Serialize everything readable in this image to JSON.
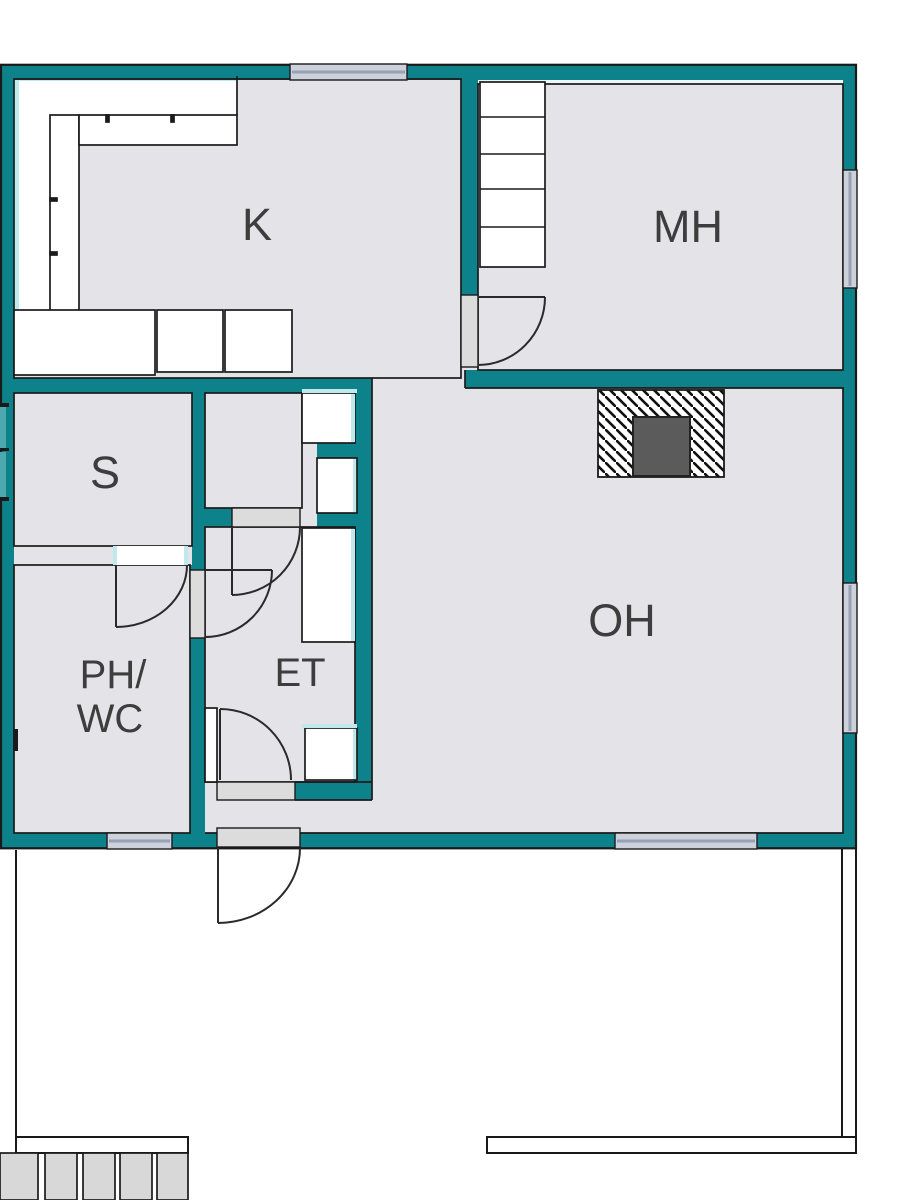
{
  "plan": {
    "type": "apartment-floor-plan",
    "rooms": {
      "k": {
        "label": "K",
        "meaning": "kitchen"
      },
      "mh": {
        "label": "MH",
        "meaning": "bedroom"
      },
      "s": {
        "label": "S",
        "meaning": "sauna"
      },
      "ph_wc": {
        "line1": "PH/",
        "line2": "WC",
        "meaning": "washroom-wc"
      },
      "et": {
        "label": "ET",
        "meaning": "entry-hall"
      },
      "oh": {
        "label": "OH",
        "meaning": "living-room"
      }
    },
    "colors": {
      "wall_teal": "#0d828b",
      "floor_gray": "#e4e3e7",
      "outline_black": "#1a1a1a",
      "window_pane": "#cdd1dc",
      "window_line": "#98a0b2",
      "threshold_gray": "#dcdcdc",
      "terrace_step_gray": "#d8d8d8",
      "fireplace_dark": "#5b5b5b",
      "wall_face_light": "#bfe9ec",
      "label_text": "#3d3d3d"
    }
  }
}
